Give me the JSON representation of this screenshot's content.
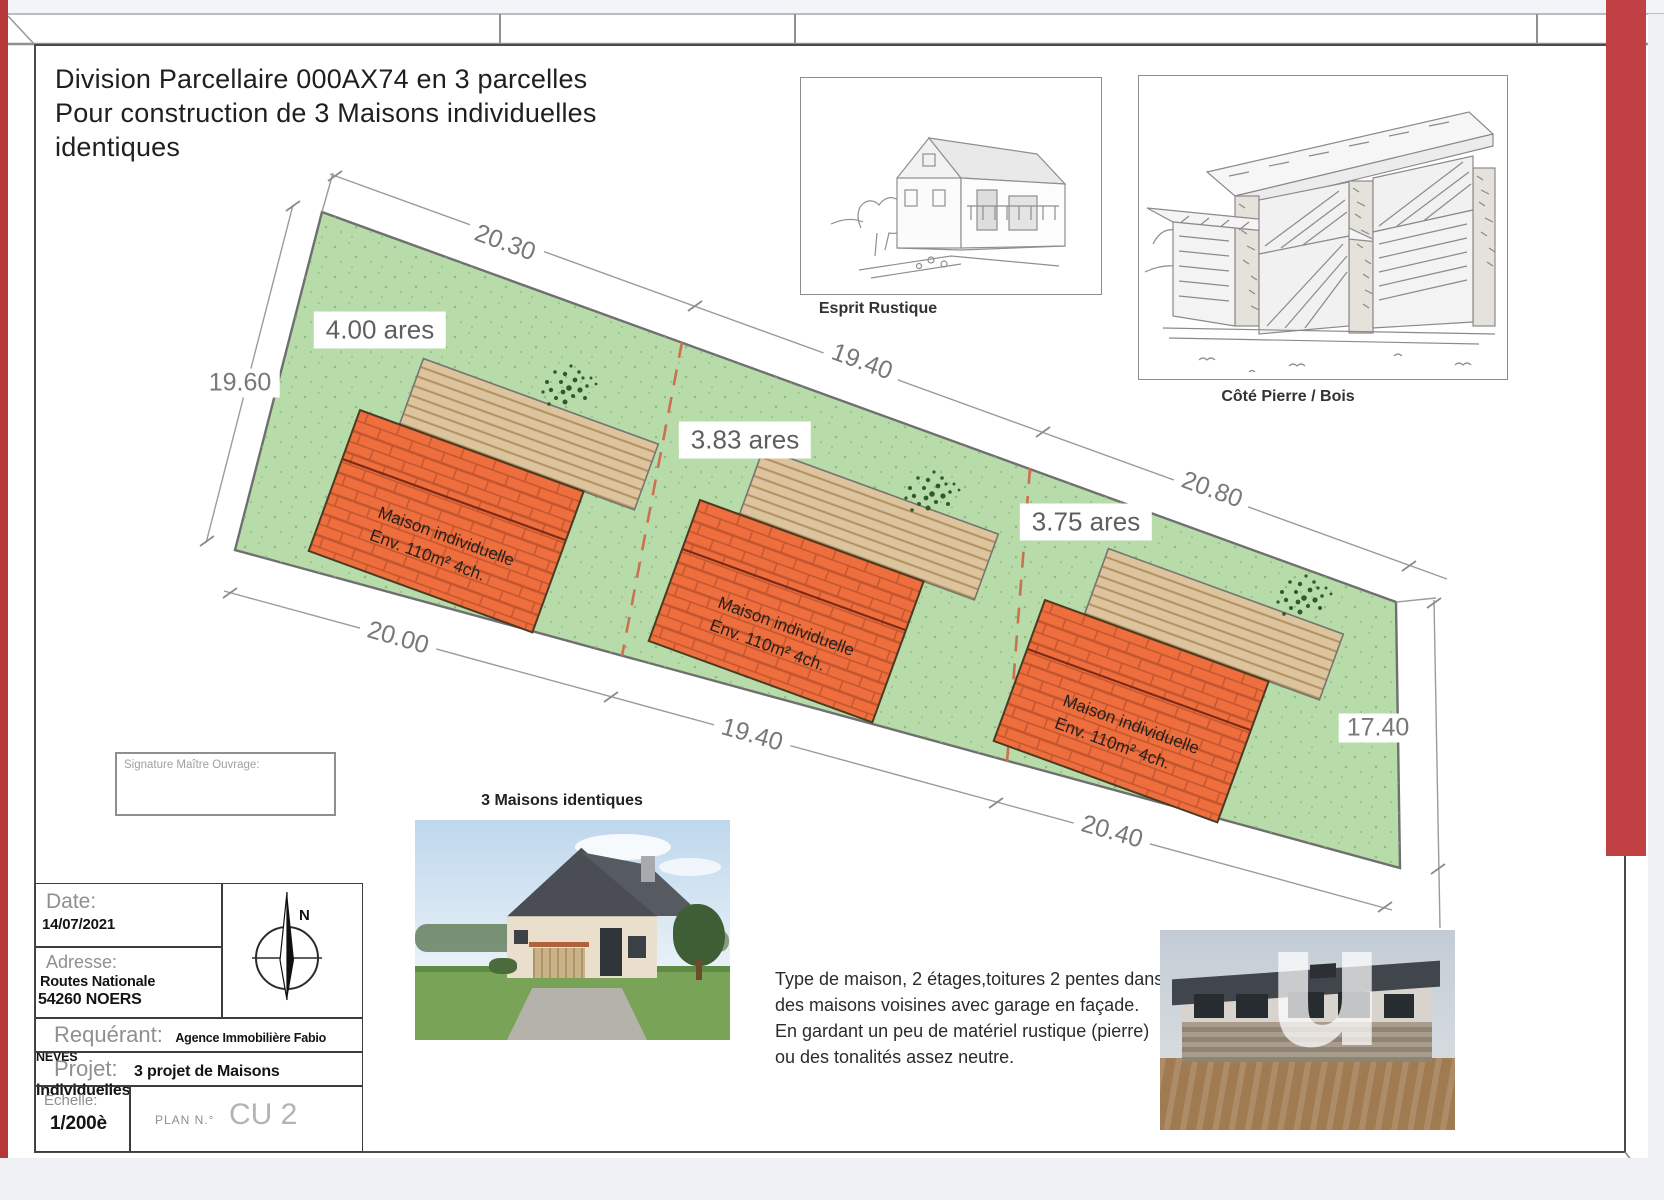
{
  "title": {
    "line1": "Division Parcellaire 000AX74 en 3 parcelles",
    "line2": "Pour construction de 3 Maisons individuelles",
    "line3": "identiques"
  },
  "sketches": {
    "rustique_label": "Esprit Rustique",
    "pierre_label": "Côté Pierre / Bois"
  },
  "plan": {
    "left_dim": "19.60",
    "right_dim": "17.40",
    "parcels": [
      {
        "area": "4.00 ares",
        "top": "20.30",
        "bottom": "20.00",
        "house1": "Maison individuelle",
        "house2": "Env. 110m² 4ch."
      },
      {
        "area": "3.83 ares",
        "top": "19.40",
        "bottom": "19.40",
        "house1": "Maison individuelle",
        "house2": "Env. 110m² 4ch."
      },
      {
        "area": "3.75 ares",
        "top": "20.80",
        "bottom": "20.40",
        "house1": "Maison individuelle",
        "house2": "Env. 110m² 4ch."
      }
    ]
  },
  "photos": {
    "identiques_caption": "3 Maisons identiques"
  },
  "description": {
    "line1": "Type de maison, 2 étages,toitures 2 pentes dans le sens",
    "line2": "des maisons voisines avec garage en façade.",
    "line3": "En gardant un peu de matériel rustique (pierre)",
    "line4": "ou des tonalités assez neutre."
  },
  "signature": {
    "label": "Signature Maître Ouvrage:"
  },
  "titleblock": {
    "date_label": "Date:",
    "date_value": "14/07/2021",
    "adresse_label": "Adresse:",
    "adresse_line1": "Routes Nationale",
    "adresse_line2": "54260 NOERS",
    "requerant_label": "Requérant:",
    "requerant_value": "Agence Immobilière Fabio NEVES",
    "projet_label": "Projet:",
    "projet_value": "3 projet de Maisons individuelles",
    "echelle_label": "Échelle:",
    "echelle_value": "1/200è",
    "plan_no_label": "PLAN N.°",
    "plan_no_value": "CU 2",
    "north_label": "N"
  },
  "watermark": {
    "glyph": "u"
  },
  "colors": {
    "parcel_green": "#b7dcaa",
    "house_orange": "#ee6e3e",
    "brick_line": "#c2552e",
    "tan_strip": "#dcc49e",
    "divider_dash": "#cb7150",
    "red_edge": "#b5373a"
  }
}
